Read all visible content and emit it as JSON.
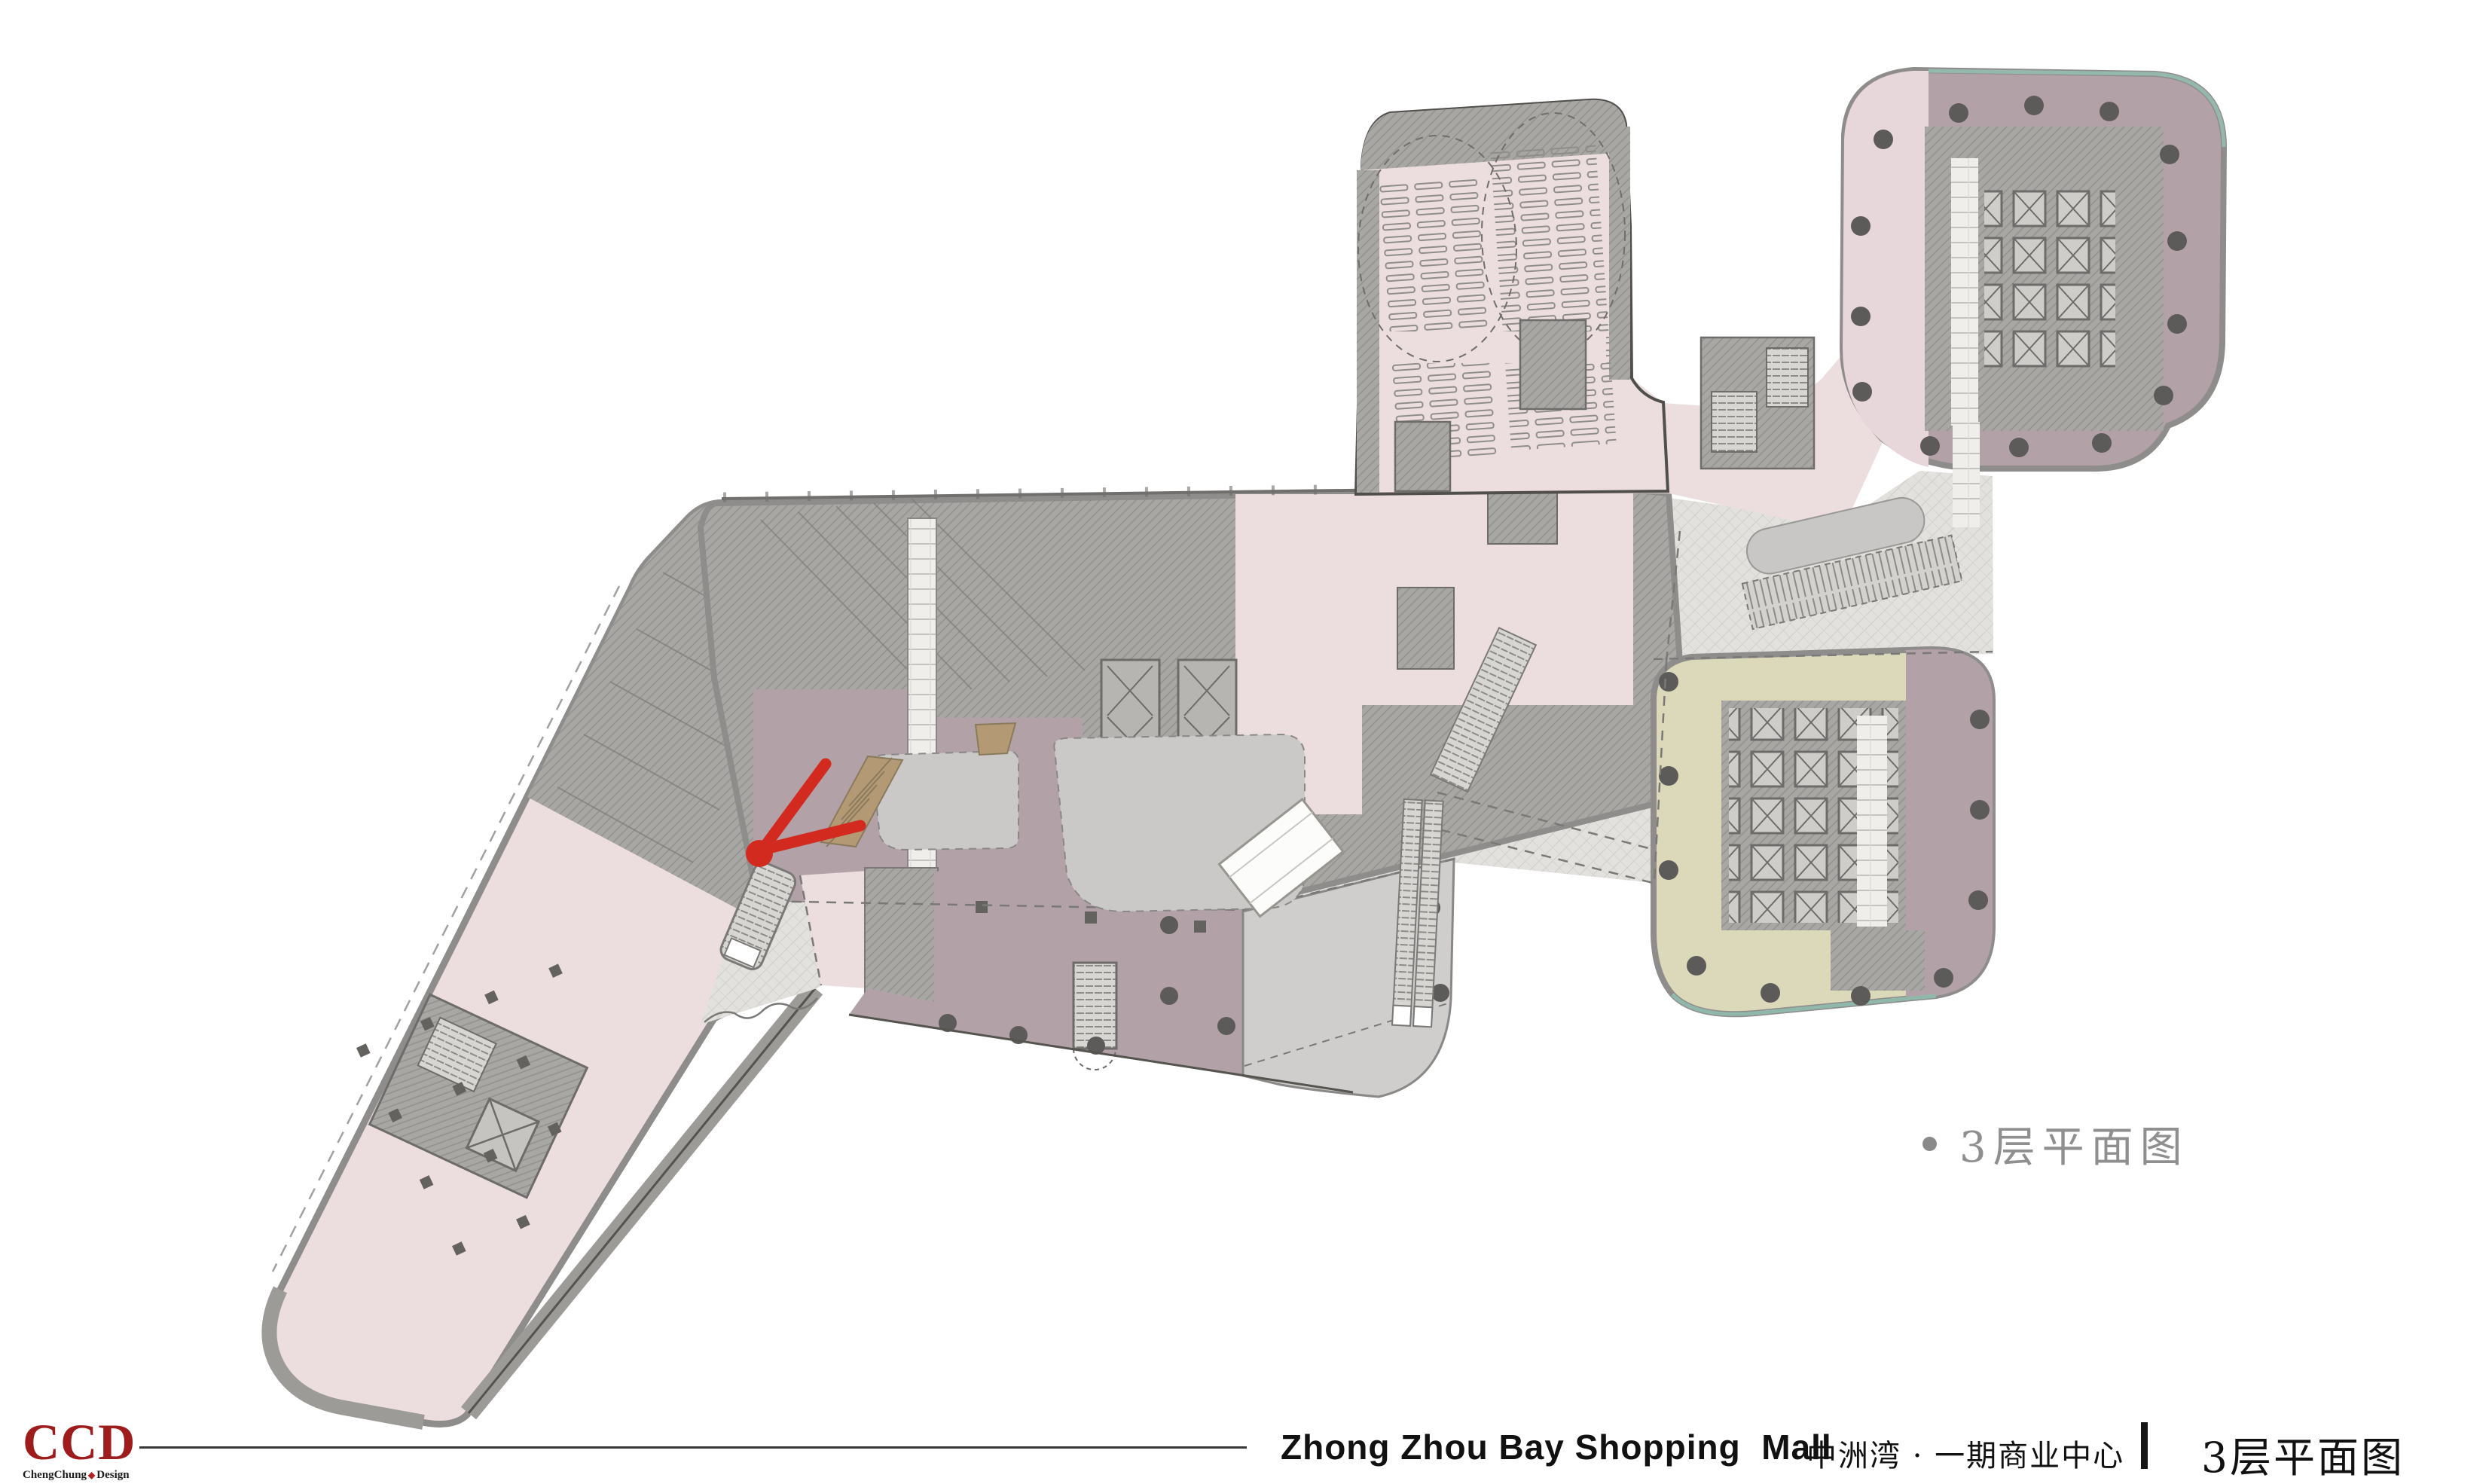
{
  "slide": {
    "background": "#ffffff"
  },
  "annotation": {
    "bullet_title": "3层平面图"
  },
  "footer": {
    "project_name_en": "Zhong Zhou Bay Shopping  Mall",
    "project_name_cn": "中洲湾 · 一期商业中心",
    "page_title": "3层平面图"
  },
  "logo": {
    "acronym": "CCD",
    "subtitle_prefix": "ChengChung",
    "subtitle_suffix": "Design",
    "separator_glyph": "◆"
  },
  "plan": {
    "label": "3F floor plan drawing",
    "colors": {
      "pink": "#ecdedf",
      "pink_band": "#e7d6da",
      "mauve": "#b2a2a8",
      "mauve_dark": "#a8969e",
      "gray_boh": "#a9a7a4",
      "wall_band": "#8f8d8b",
      "walkway": "#e3e1dd",
      "void_gray": "#cbc9c7",
      "terrace_gray": "#d0cecc",
      "olive": "#dcd8ba",
      "wood": "#b49a74",
      "red": "#d32a20",
      "teal": "#97bfb2",
      "column_dot": "#5d5b59"
    }
  }
}
